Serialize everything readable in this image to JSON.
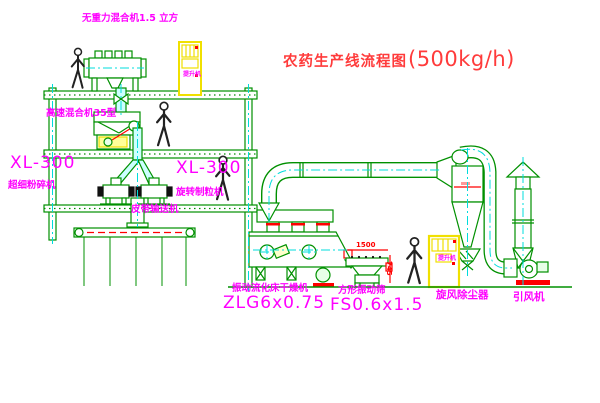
{
  "title": {
    "text": "农药生产线流程图",
    "capacity": "(500kg/h)"
  },
  "machines": {
    "gravity_mixer": {
      "label": "无重力混合机1.5 立方"
    },
    "high_speed_mixer": {
      "label": "高速混合机35型"
    },
    "mill": {
      "model": "XL-300",
      "name": "超细粉碎机"
    },
    "granulator": {
      "model": "XL-300",
      "name": "旋转制粒机"
    },
    "belt_conveyor": {
      "label": "皮带输送机"
    },
    "fluid_bed_dryer": {
      "name": "振动流化床干燥机",
      "model": "ZLG6x0.75"
    },
    "square_sieve": {
      "name": "方形振动筛",
      "model": "FS0.6x1.5"
    },
    "cyclone": {
      "label": "旋风除尘器"
    },
    "induced_draft_fan": {
      "label": "引风机"
    },
    "bucket_elevator": {
      "label": "提升机"
    }
  },
  "dimensions": {
    "sieve_length": "1500",
    "sieve_height": "745"
  },
  "colors": {
    "line_green": "#009000",
    "centerline_cyan": "#00dcdc",
    "label_magenta": "#ff00ff",
    "title_red": "#ff3b3b",
    "detail_red": "#ff0000",
    "equipment_yellow": "#f0e000",
    "pipe_fill_cyan": "#ccffff"
  }
}
